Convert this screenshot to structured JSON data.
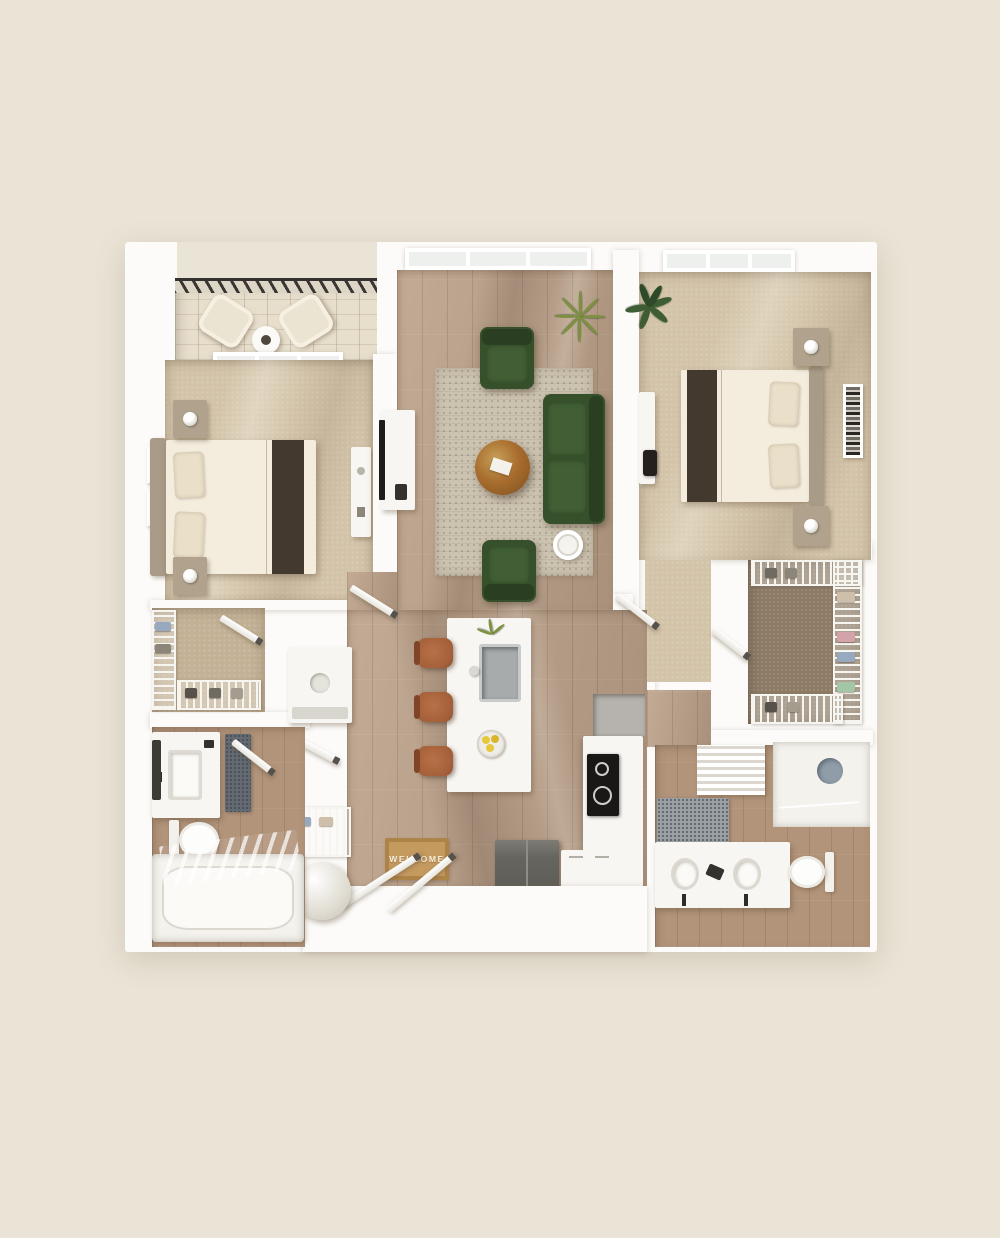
{
  "scene": {
    "subject": "3D rendered two-bedroom apartment floor plan, top-down view",
    "style": "photoreal architectural render on cream background"
  },
  "entry": {
    "welcome_mat_text": "WELCOME"
  },
  "palette": {
    "background": "#eae4d6",
    "wall": "#fcfbf9",
    "glass": "#eef0ee",
    "wood": "#bca189",
    "tile": "#b2947a",
    "carpet": "#d3c4a9",
    "balcony": "#e7decc",
    "closetFloor": "#8d7b66",
    "rugColor": "#ccc2b0",
    "sofaGreen": "#36502c",
    "sofaGreenLight": "#415e35",
    "sofaGreenDark": "#2a3f22",
    "coffeeTable": "#a96e2f",
    "stool": "#a5603a",
    "matColor": "#c49a5f",
    "matBorder": "#ae8348",
    "lemon": "#e7c83b",
    "plant": "#3f5d35",
    "plantLight": "#7e9140",
    "dark": "#33291f",
    "steel": "#66655f",
    "drain": "#8e9da8"
  },
  "rooms": [
    {
      "id": "balcony",
      "label": "balcony with two lounge chairs and round table"
    },
    {
      "id": "bedroom-left",
      "label": "bedroom with queen bed, nightstands, wall art, dresser"
    },
    {
      "id": "living-room",
      "label": "living room with green sofa, two green armchairs, rug, round coffee table, TV console, plants"
    },
    {
      "id": "bedroom-right",
      "label": "bedroom with queen bed, nightstands, desk, wall art, plant"
    },
    {
      "id": "walk-in-closet-left",
      "label": "walk-in closet with wire shelving"
    },
    {
      "id": "walk-in-closet-right",
      "label": "walk-in closet with wire shelving and shoes"
    },
    {
      "id": "bathroom-left",
      "label": "bathroom with vanity, toilet, tub-shower"
    },
    {
      "id": "bathroom-right",
      "label": "bathroom with double vanity, toilet, walk-in shower, linen shelves"
    },
    {
      "id": "kitchen",
      "label": "kitchen with island, sink, three bar stools, cooktop, refrigerator"
    },
    {
      "id": "laundry-utility",
      "label": "stacked washer-dryer closet, wire storage and water heater"
    },
    {
      "id": "entry",
      "label": "entry with double doors and welcome mat"
    }
  ],
  "furniture_inventory": [
    "lounge-chair x2",
    "patio-table",
    "queen-bed x2",
    "nightstand x4",
    "table-lamp x4",
    "wall-art x3",
    "dresser",
    "desk-with-chair",
    "tv-console",
    "green-sofa",
    "green-armchair x2",
    "round-coffee-table",
    "side-table",
    "area-rug",
    "potted-plant x2",
    "kitchen-island",
    "island-sink",
    "bar-stool x3",
    "flower-vase",
    "lemon-bowl",
    "cooktop",
    "microwave-nook",
    "refrigerator",
    "base-cabinets",
    "welcome-mat",
    "washer-dryer-stack",
    "wire-shelf-closet x3",
    "water-heater",
    "vanity-sink",
    "double-vanity",
    "toilet x2",
    "bathtub",
    "walk-in-shower",
    "bath-mat x2",
    "linen-shelf"
  ]
}
